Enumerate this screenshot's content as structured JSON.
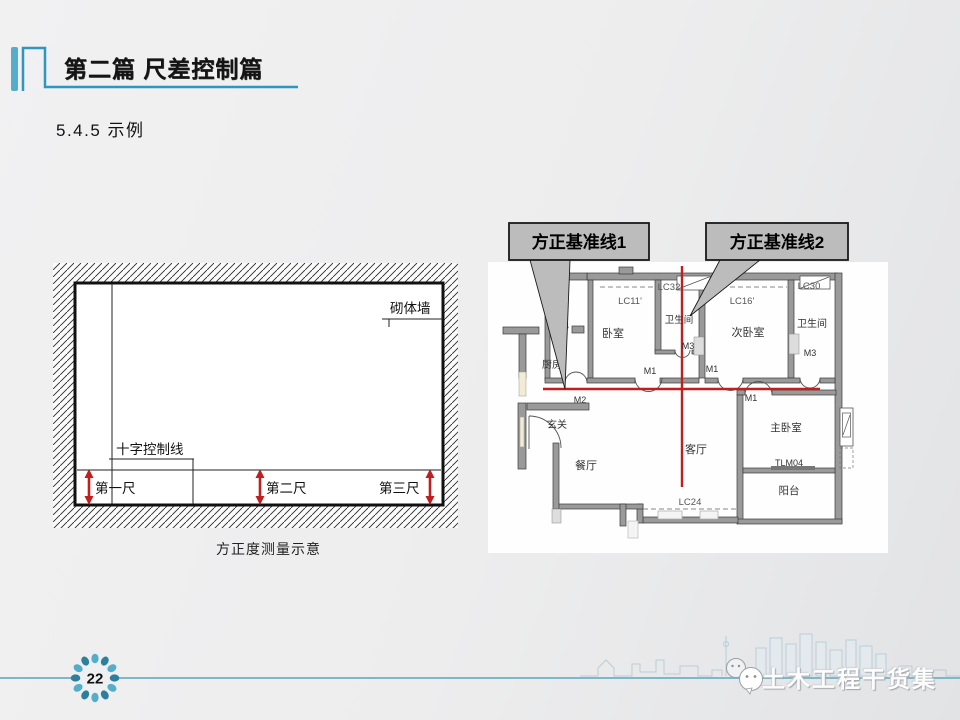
{
  "header": {
    "title": "第二篇  尺差控制篇"
  },
  "section_title": "5.4.5 示例",
  "diagram": {
    "caption": "方正度测量示意",
    "wall_label": "砌体墙",
    "cross_line_label": "十字控制线",
    "ruler1": "第一尺",
    "ruler2": "第二尺",
    "ruler3": "第三尺"
  },
  "plan": {
    "callout1": "方正基准线1",
    "callout2": "方正基准线2",
    "labels": {
      "bedroom": "卧室",
      "bathroom": "卫生间",
      "second_bedroom": "次卧室",
      "master_bedroom": "主卧室",
      "living_room": "客厅",
      "dining_room": "餐厅",
      "entry": "玄关",
      "kitchen": "厨房",
      "balcony": "阳台",
      "b_mark": "B"
    },
    "codes": {
      "lc11": "LC11'",
      "lc16": "LC16'",
      "lc24": "LC24",
      "lc30": "LC30",
      "lc32": "LC32",
      "m1": "M1",
      "m2": "M2",
      "m3": "M3",
      "tlm04": "TLM04"
    }
  },
  "footer": {
    "page_number": "22",
    "watermark": "土木工程干货集"
  },
  "colors": {
    "accent_teal": "#2f96bf",
    "footer_line_teal": "#7fb7ca",
    "datum_red": "#c01f1f",
    "callout_gray": "#bcbcbc"
  }
}
